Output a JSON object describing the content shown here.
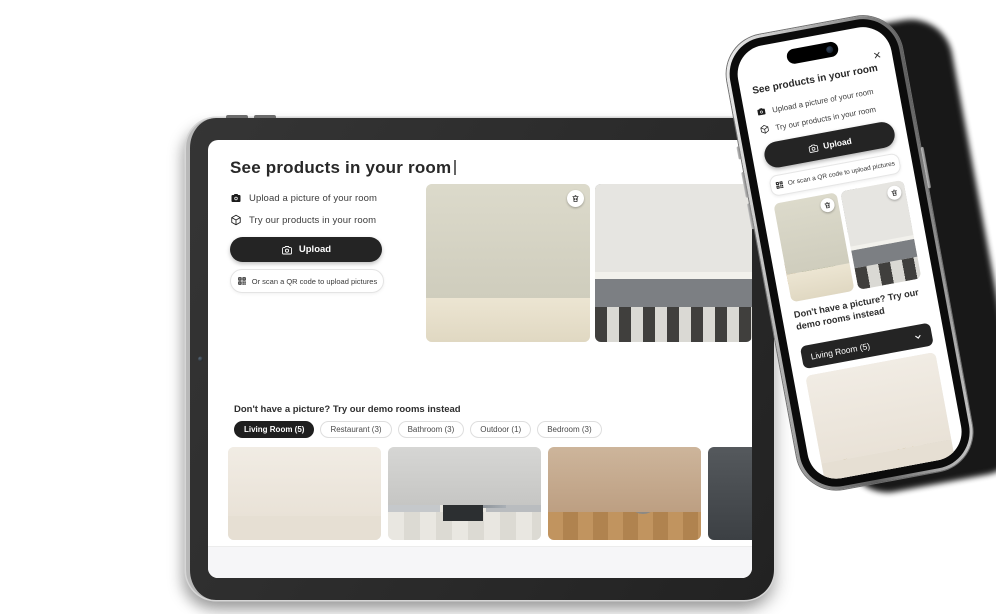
{
  "app": {
    "title": "See products in your room",
    "features": [
      {
        "icon": "camera-icon",
        "label": "Upload a picture of your room"
      },
      {
        "icon": "cube-icon",
        "label": "Try our products in your room"
      }
    ],
    "upload_button_label": "Upload",
    "qr_button_label": "Or scan a QR code to upload pictures",
    "demo_section_title": "Don't have a picture? Try our demo rooms instead",
    "demo_tabs": [
      {
        "label": "Living Room (5)",
        "active": true
      },
      {
        "label": "Restaurant (3)",
        "active": false
      },
      {
        "label": "Bathroom (3)",
        "active": false
      },
      {
        "label": "Outdoor (1)",
        "active": false
      },
      {
        "label": "Bedroom (3)",
        "active": false
      }
    ],
    "mobile_demo_dropdown_value": "Living Room (5)",
    "close_button_label": "×"
  },
  "colors": {
    "accent_dark": "#242424",
    "screen_bg": "#ffffff",
    "pill_border": "#e4e4e4",
    "text_primary": "#2b2b2b",
    "footer_bg": "#f6f6f8"
  }
}
